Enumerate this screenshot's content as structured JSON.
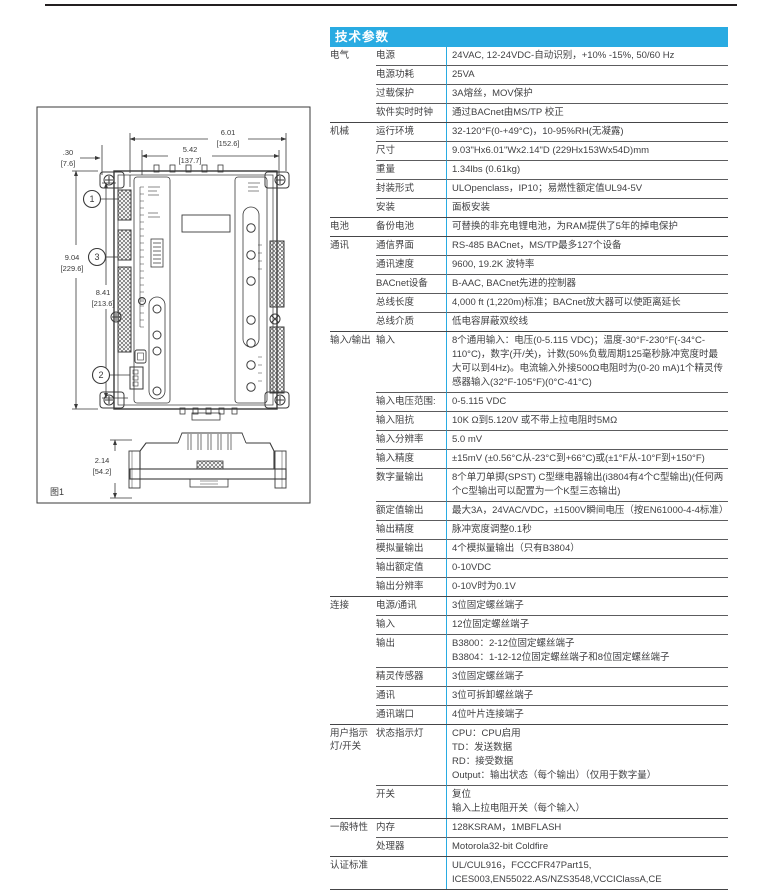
{
  "accent_color": "#29ABE2",
  "drawing": {
    "figure_label": "图1",
    "callouts": {
      "c1": "1",
      "c2": "2",
      "c3": "3"
    },
    "dims": {
      "w_in": "6.01",
      "w_mm": "[152.6]",
      "iw_in": "5.42",
      "iw_mm": "[137.7]",
      "off_in": ".30",
      "off_mm": "[7.6]",
      "h_in": "9.04",
      "h_mm": "[229.6]",
      "ih_in": "8.41",
      "ih_mm": "[213.6]",
      "d_in": "2.14",
      "d_mm": "[54.2]"
    }
  },
  "table": {
    "title": "技术参数",
    "groups": [
      {
        "category": "电气",
        "rows": [
          {
            "label": "电源",
            "lines": [
              "24VAC, 12-24VDC-自动识别，+10% -15%, 50/60 Hz"
            ]
          },
          {
            "label": "电源功耗",
            "lines": [
              "25VA"
            ]
          },
          {
            "label": "过载保护",
            "lines": [
              "3A熔丝，MOV保护"
            ]
          },
          {
            "label": "软件实时时钟",
            "lines": [
              "通过BACnet由MS/TP 校正"
            ]
          }
        ]
      },
      {
        "category": "机械",
        "rows": [
          {
            "label": "运行环境",
            "lines": [
              "32-120°F(0-+49°C)，10-95%RH(无凝露)"
            ]
          },
          {
            "label": "尺寸",
            "lines": [
              "9.03\"Hx6.01\"Wx2.14\"D (229Hx153Wx54D)mm"
            ]
          },
          {
            "label": "重量",
            "lines": [
              "1.34lbs (0.61kg)"
            ]
          },
          {
            "label": "封装形式",
            "lines": [
              "ULOpenclass，IP10；易燃性额定值UL94-5V"
            ]
          },
          {
            "label": "安装",
            "lines": [
              "面板安装"
            ]
          }
        ]
      },
      {
        "category": "电池",
        "rows": [
          {
            "label": "备份电池",
            "lines": [
              "可替换的非充电锂电池，为RAM提供了5年的掉电保护"
            ]
          }
        ]
      },
      {
        "category": "通讯",
        "rows": [
          {
            "label": "通信界面",
            "lines": [
              "RS-485 BACnet，MS/TP最多127个设备"
            ]
          },
          {
            "label": "通讯速度",
            "lines": [
              "9600, 19.2K 波特率"
            ]
          },
          {
            "label": "BACnet设备",
            "lines": [
              "B-AAC, BACnet先进的控制器"
            ]
          },
          {
            "label": "总线长度",
            "lines": [
              "4,000 ft (1,220m)标准；BACnet放大器可以使距离延长"
            ]
          },
          {
            "label": "总线介质",
            "lines": [
              "低电容屏蔽双绞线"
            ]
          }
        ]
      },
      {
        "category": "输入/输出",
        "rows": [
          {
            "label": "输入",
            "lines": [
              "8个通用输入：电压(0-5.115 VDC)；温度-30°F-230°F(-34°C-110°C)，数字(开/关)，计数(50%负载周期125毫秒脉冲宽度时最大可以到4Hz)。电流输入外接500Ω电阻时为(0-20 mA)1个精灵传感器输入(32°F-105°F)(0°C-41°C)"
            ]
          },
          {
            "label": "输入电压范围:",
            "lines": [
              "0-5.115 VDC"
            ]
          },
          {
            "label": "输入阻抗",
            "lines": [
              "10K Ω到5.120V 或不带上拉电阻时5MΩ"
            ]
          },
          {
            "label": "输入分辨率",
            "lines": [
              "5.0 mV"
            ]
          },
          {
            "label": "输入精度",
            "lines": [
              "±15mV (±0.56°C从-23°C到+66°C)或(±1°F从-10°F到+150°F)"
            ]
          },
          {
            "label": "数字量输出",
            "lines": [
              "8个单刀单掷(SPST) C型继电器输出(i3804有4个C型输出)(任何两个C型输出可以配置为一个K型三态输出)"
            ]
          },
          {
            "label": "额定值输出",
            "lines": [
              "最大3A，24VAC/VDC，±1500V瞬间电压（按EN61000-4-4标准）"
            ]
          },
          {
            "label": "输出精度",
            "lines": [
              "脉冲宽度调整0.1秒"
            ]
          },
          {
            "label": "模拟量输出",
            "lines": [
              "4个模拟量输出（只有B3804）"
            ]
          },
          {
            "label": "输出额定值",
            "lines": [
              "0-10VDC"
            ]
          },
          {
            "label": "输出分辨率",
            "lines": [
              "0-10V时为0.1V"
            ]
          }
        ]
      },
      {
        "category": "连接",
        "rows": [
          {
            "label": "电源/通讯",
            "lines": [
              "3位固定螺丝端子"
            ]
          },
          {
            "label": "输入",
            "lines": [
              "12位固定螺丝端子"
            ]
          },
          {
            "label": "输出",
            "lines": [
              "B3800：2-12位固定螺丝端子",
              "B3804：1-12-12位固定螺丝端子和8位固定螺丝端子"
            ]
          },
          {
            "label": "精灵传感器",
            "lines": [
              "3位固定螺丝端子"
            ]
          },
          {
            "label": "通讯",
            "lines": [
              "3位可拆卸螺丝端子"
            ]
          },
          {
            "label": "通讯端口",
            "lines": [
              "4位叶片连接端子"
            ]
          }
        ]
      },
      {
        "category": "用户指示灯/开关",
        "rows": [
          {
            "label": "状态指示灯",
            "lines": [
              "CPU：CPU启用",
              "TD：发送数据",
              "RD：接受数据",
              "Output：输出状态（每个输出）（仅用于数字量）"
            ]
          },
          {
            "label": "开关",
            "lines": [
              "复位",
              "输入上拉电阻开关（每个输入）"
            ]
          }
        ]
      },
      {
        "category": "一般特性",
        "rows": [
          {
            "label": "内存",
            "lines": [
              "128KSRAM，1MBFLASH"
            ]
          },
          {
            "label": "处理器",
            "lines": [
              "Motorola32-bit Coldfire"
            ]
          }
        ]
      },
      {
        "category": "认证标准",
        "rows": [
          {
            "label": "",
            "lines": [
              "UL/CUL916，FCCCFR47Part15, ICES003,EN55022.AS/NZS3548,VCCIClassA,CE"
            ]
          }
        ]
      }
    ]
  }
}
